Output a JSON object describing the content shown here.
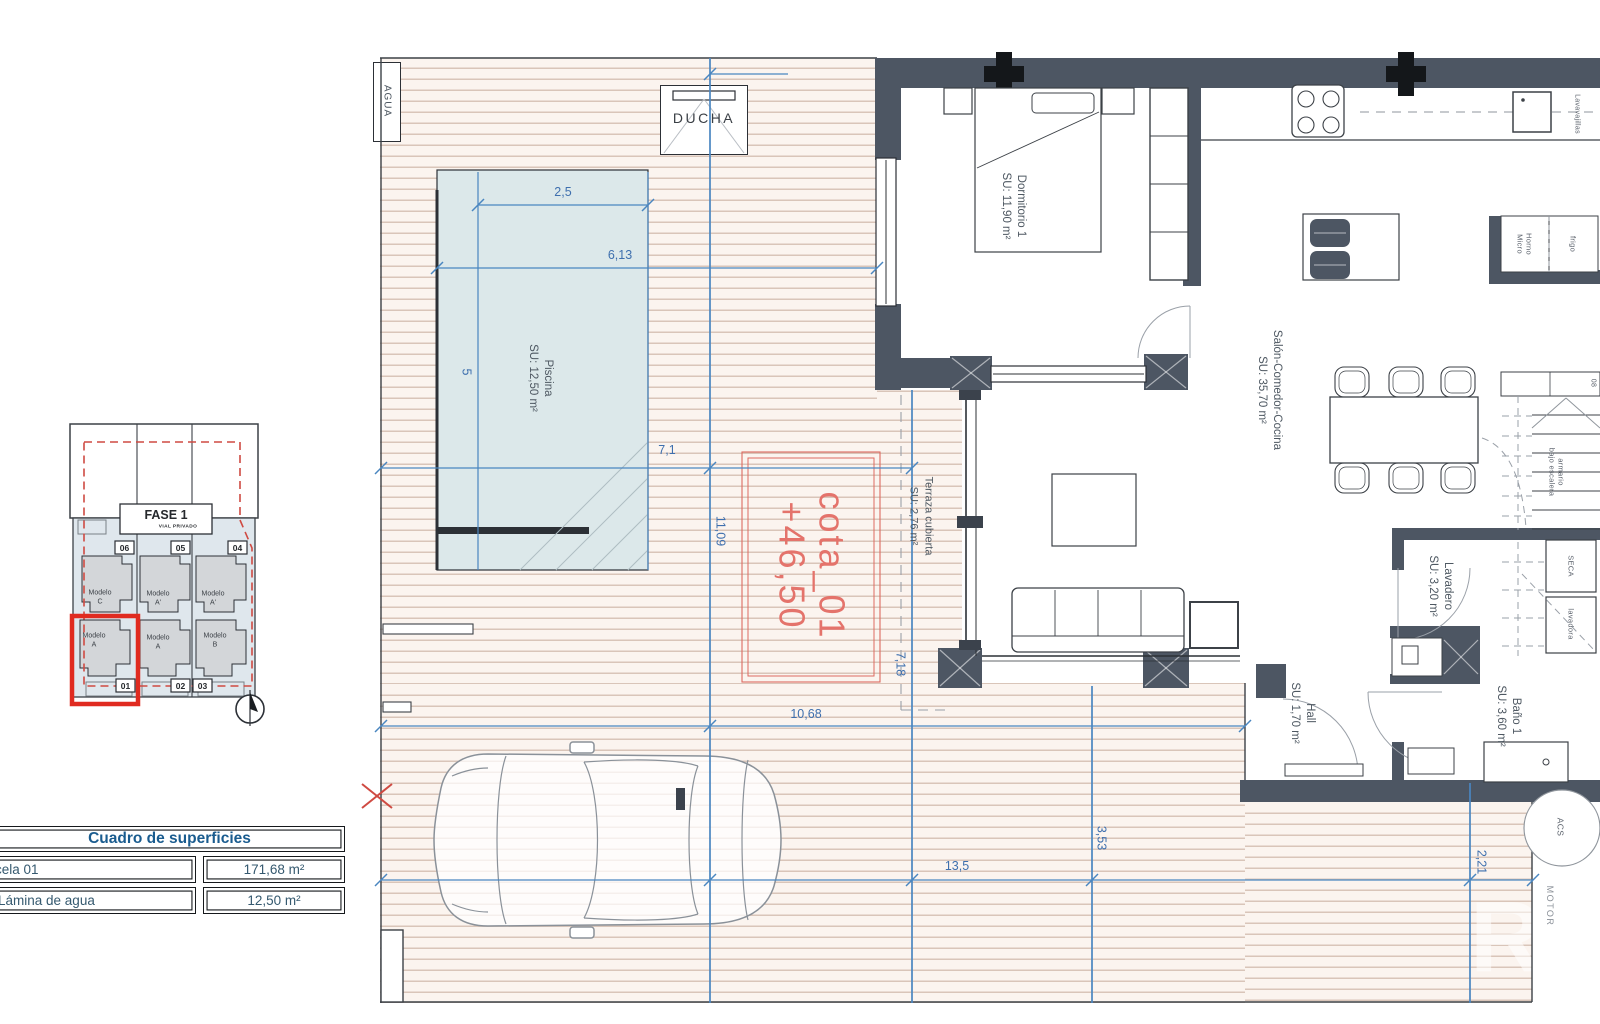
{
  "plan": {
    "agua": "AGUA",
    "ducha": "DUCHA",
    "piscina_name": "Piscina",
    "piscina_area": "SU: 12,50 m²",
    "dorm_name": "Dormitorio 1",
    "dorm_area": "SU: 11,90 m²",
    "salon_name": "Salón-Comedor-Cocina",
    "salon_area": "SU: 35,70 m²",
    "terraza_name": "Terraza cubierta",
    "terraza_area": "SU: 2,76 m²",
    "lav_name": "Lavadero",
    "lav_area": "SU: 3,20 m²",
    "bano_name": "Baño 1",
    "bano_area": "SU: 3,60 m²",
    "hall_name": "Hall",
    "hall_area": "SU: 1,70 m²",
    "cota_name": "cota_01",
    "cota_level": "+46,50",
    "dim_pool_w": "2,5",
    "dim_deck_a": "6,13",
    "dim_pool_l": "5",
    "dim_deck_b": "7,1",
    "dim_deck_h": "11,09",
    "dim_deck_c": "10,68",
    "dim_terr_h": "7,18",
    "dim_deck_d": "13,5",
    "dim_south_h": "3,53",
    "dim_east_h": "2,21",
    "lavavajillas": "Lavavajillas",
    "horno": "Horno",
    "micro": "Micro",
    "frigo": "frigo",
    "armario_l1": "armario",
    "armario_l2": "bajo escalera",
    "seca": "SECA",
    "lavadora": "lavadora",
    "acs": "ACS",
    "motor": "MOTOR",
    "stair_num": "08",
    "watermark": "R"
  },
  "site_key": {
    "phase": "FASE 1",
    "phase_sub": "VIAL PRIVADO",
    "plots_top": [
      "06",
      "05",
      "04"
    ],
    "plots_bottom": [
      "01",
      "02",
      "03"
    ],
    "model_word": "Modelo",
    "models_top": [
      "C",
      "A'",
      "A'"
    ],
    "models_bottom": [
      "A",
      "A",
      "B"
    ]
  },
  "surfaces_table": {
    "title": "Cuadro de superficies",
    "rows": [
      {
        "label": "arcela 01",
        "value": "171,68 m²"
      },
      {
        "label": "p. Lámina de agua",
        "value": "12,50 m²"
      }
    ]
  },
  "colors": {
    "wall": "#4d5663",
    "dim_blue": "#4a86c0",
    "cota_red": "#e4736b",
    "highlight_red": "#e02b20",
    "pool_fill": "#dce8ea",
    "deck_stripe": "#d9c5b9",
    "table_blue": "#1a5c8f"
  }
}
